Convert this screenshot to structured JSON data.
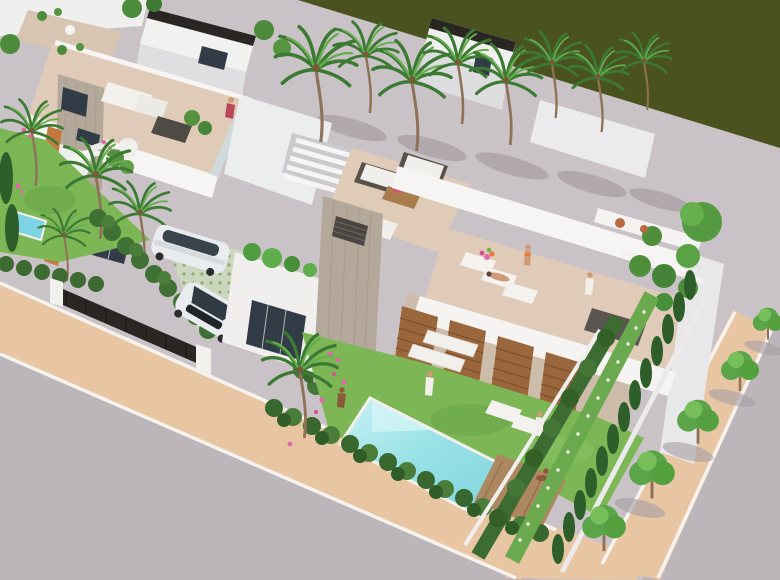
{
  "meta": {
    "title": "Aerial 3D architectural render of modern white villas",
    "alt": "Aerial isometric 3D rendering of a row of modern flat-roofed white villas with roof terraces, sunbathers, a long turquoise private pool with wooden deck, gardens with palm trees and hedges, two parked white cars, a palm-lined grey promenade beside a dark green course, and a grey street with a terracotta tree-lined sidewalk."
  },
  "palette": {
    "golf_green": "#4a5220",
    "promenade": "#c9c2c6",
    "shadow_grey": "#a69ea3",
    "road": "#bcb5b9",
    "sidewalk": "#e9c6a3",
    "curb": "#f6f3ef",
    "wall_white": "#f4f3f1",
    "wall_shade": "#dddde1",
    "fascia_dark": "#2a2623",
    "concrete": "#b3a899",
    "window_dark": "#323c46",
    "wood_louver": "#9a673c",
    "terrace_floor": "#e0cbb8",
    "pool_water": "#8edde3",
    "deck_wood": "#ad8760",
    "lawn": "#7cb655",
    "hedge_dark": "#3c6c31",
    "cypress": "#2e5f2b",
    "tree_green": "#5ba449",
    "palm_green": "#3c7a34",
    "trunk": "#8f7157",
    "car_white": "#e9ecee",
    "skin": "#cf9a76",
    "accent_orange": "#e8793c",
    "flower_pink": "#e06aa8",
    "glass_rail": "#cddce2",
    "driveway_paver": "#ccd6bf"
  },
  "scene": {
    "setting": "coastal residential development, aerial isometric view",
    "elements": [
      {
        "name": "golf-course",
        "label": "dark green course / water strip along the top right"
      },
      {
        "name": "promenade",
        "label": "light grey promenade lined with coconut palms"
      },
      {
        "name": "left-villa",
        "label": "white villa with roof terrace, concrete tower, lounge furniture"
      },
      {
        "name": "main-villa",
        "label": "foreground villa with concrete chimney tower, wooden louvre screens and roof terrace"
      },
      {
        "name": "roof-terrace-sunbathers",
        "label": "people on sun loungers on the roof terrace"
      },
      {
        "name": "pool",
        "label": "long rectangular turquoise pool with timber deck"
      },
      {
        "name": "garden",
        "label": "lawned gardens with pink flowers, stepping stones and palms"
      },
      {
        "name": "cars",
        "label": "two white cars on a grass-paver driveway behind a dark gate"
      },
      {
        "name": "street",
        "label": "grey asphalt street with terracotta sidewalk, white kerbs and young street trees"
      },
      {
        "name": "hedges",
        "label": "clipped hedge rows and cypress screen along the right boundary"
      }
    ]
  }
}
